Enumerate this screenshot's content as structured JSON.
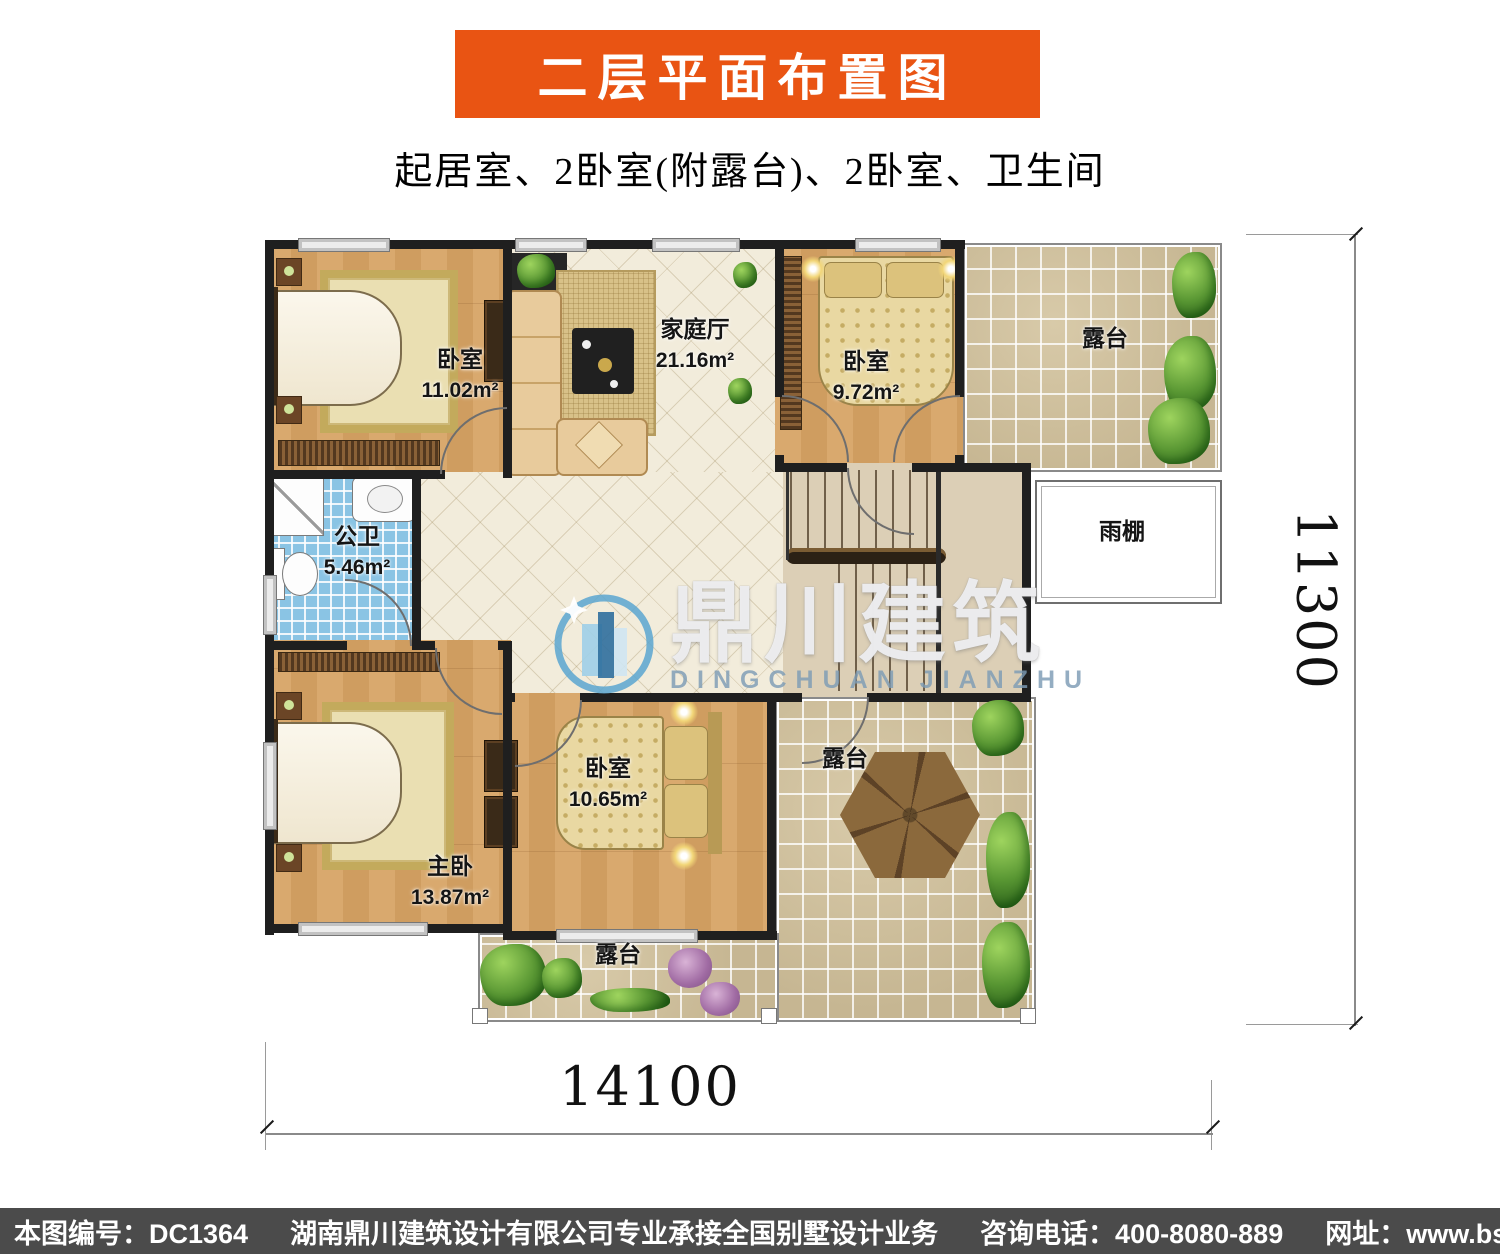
{
  "header": {
    "banner_title": "二层平面布置图",
    "subtitle": "起居室、2卧室(附露台)、2卧室、卫生间"
  },
  "plan": {
    "rooms": {
      "bedroom_top_left": {
        "label": "卧室",
        "area": "11.02m²"
      },
      "family_hall": {
        "label": "家庭厅",
        "area": "21.16m²"
      },
      "bedroom_top_right": {
        "label": "卧室",
        "area": "9.72m²"
      },
      "bathroom": {
        "label": "公卫",
        "area": "5.46m²"
      },
      "master_bedroom": {
        "label": "主卧",
        "area": "13.87m²"
      },
      "bedroom_bottom": {
        "label": "卧室",
        "area": "10.65m²"
      },
      "terrace_top_right": {
        "label": "露台"
      },
      "terrace_bottom_right": {
        "label": "露台"
      },
      "terrace_bottom": {
        "label": "露台"
      },
      "rain_canopy": {
        "label": "雨棚"
      }
    },
    "dimensions": {
      "width_mm": "14100",
      "height_mm": "11300"
    }
  },
  "watermark": {
    "cn": "鼎川建筑",
    "en": "DINGCHUAN JIANZHU"
  },
  "footer": {
    "drawing_no": "本图编号：DC1364",
    "company": "湖南鼎川建筑设计有限公司专业承接全国别墅设计业务",
    "phone": "咨询电话：400-8080-889",
    "website": "网址：www.bstzcs.com"
  },
  "colors": {
    "banner_bg": "#E95413",
    "footer_bg": "#4B4B4B",
    "wall": "#1F1F1F",
    "wood_floor": "#D5A469",
    "hall_tile": "#F2ECDB",
    "terrace_tile": "#CDBE9E",
    "bathroom_tile": "#8AC4E4",
    "stair_landing": "#DCCFB6",
    "watermark_blue": "#5BA6D0"
  }
}
